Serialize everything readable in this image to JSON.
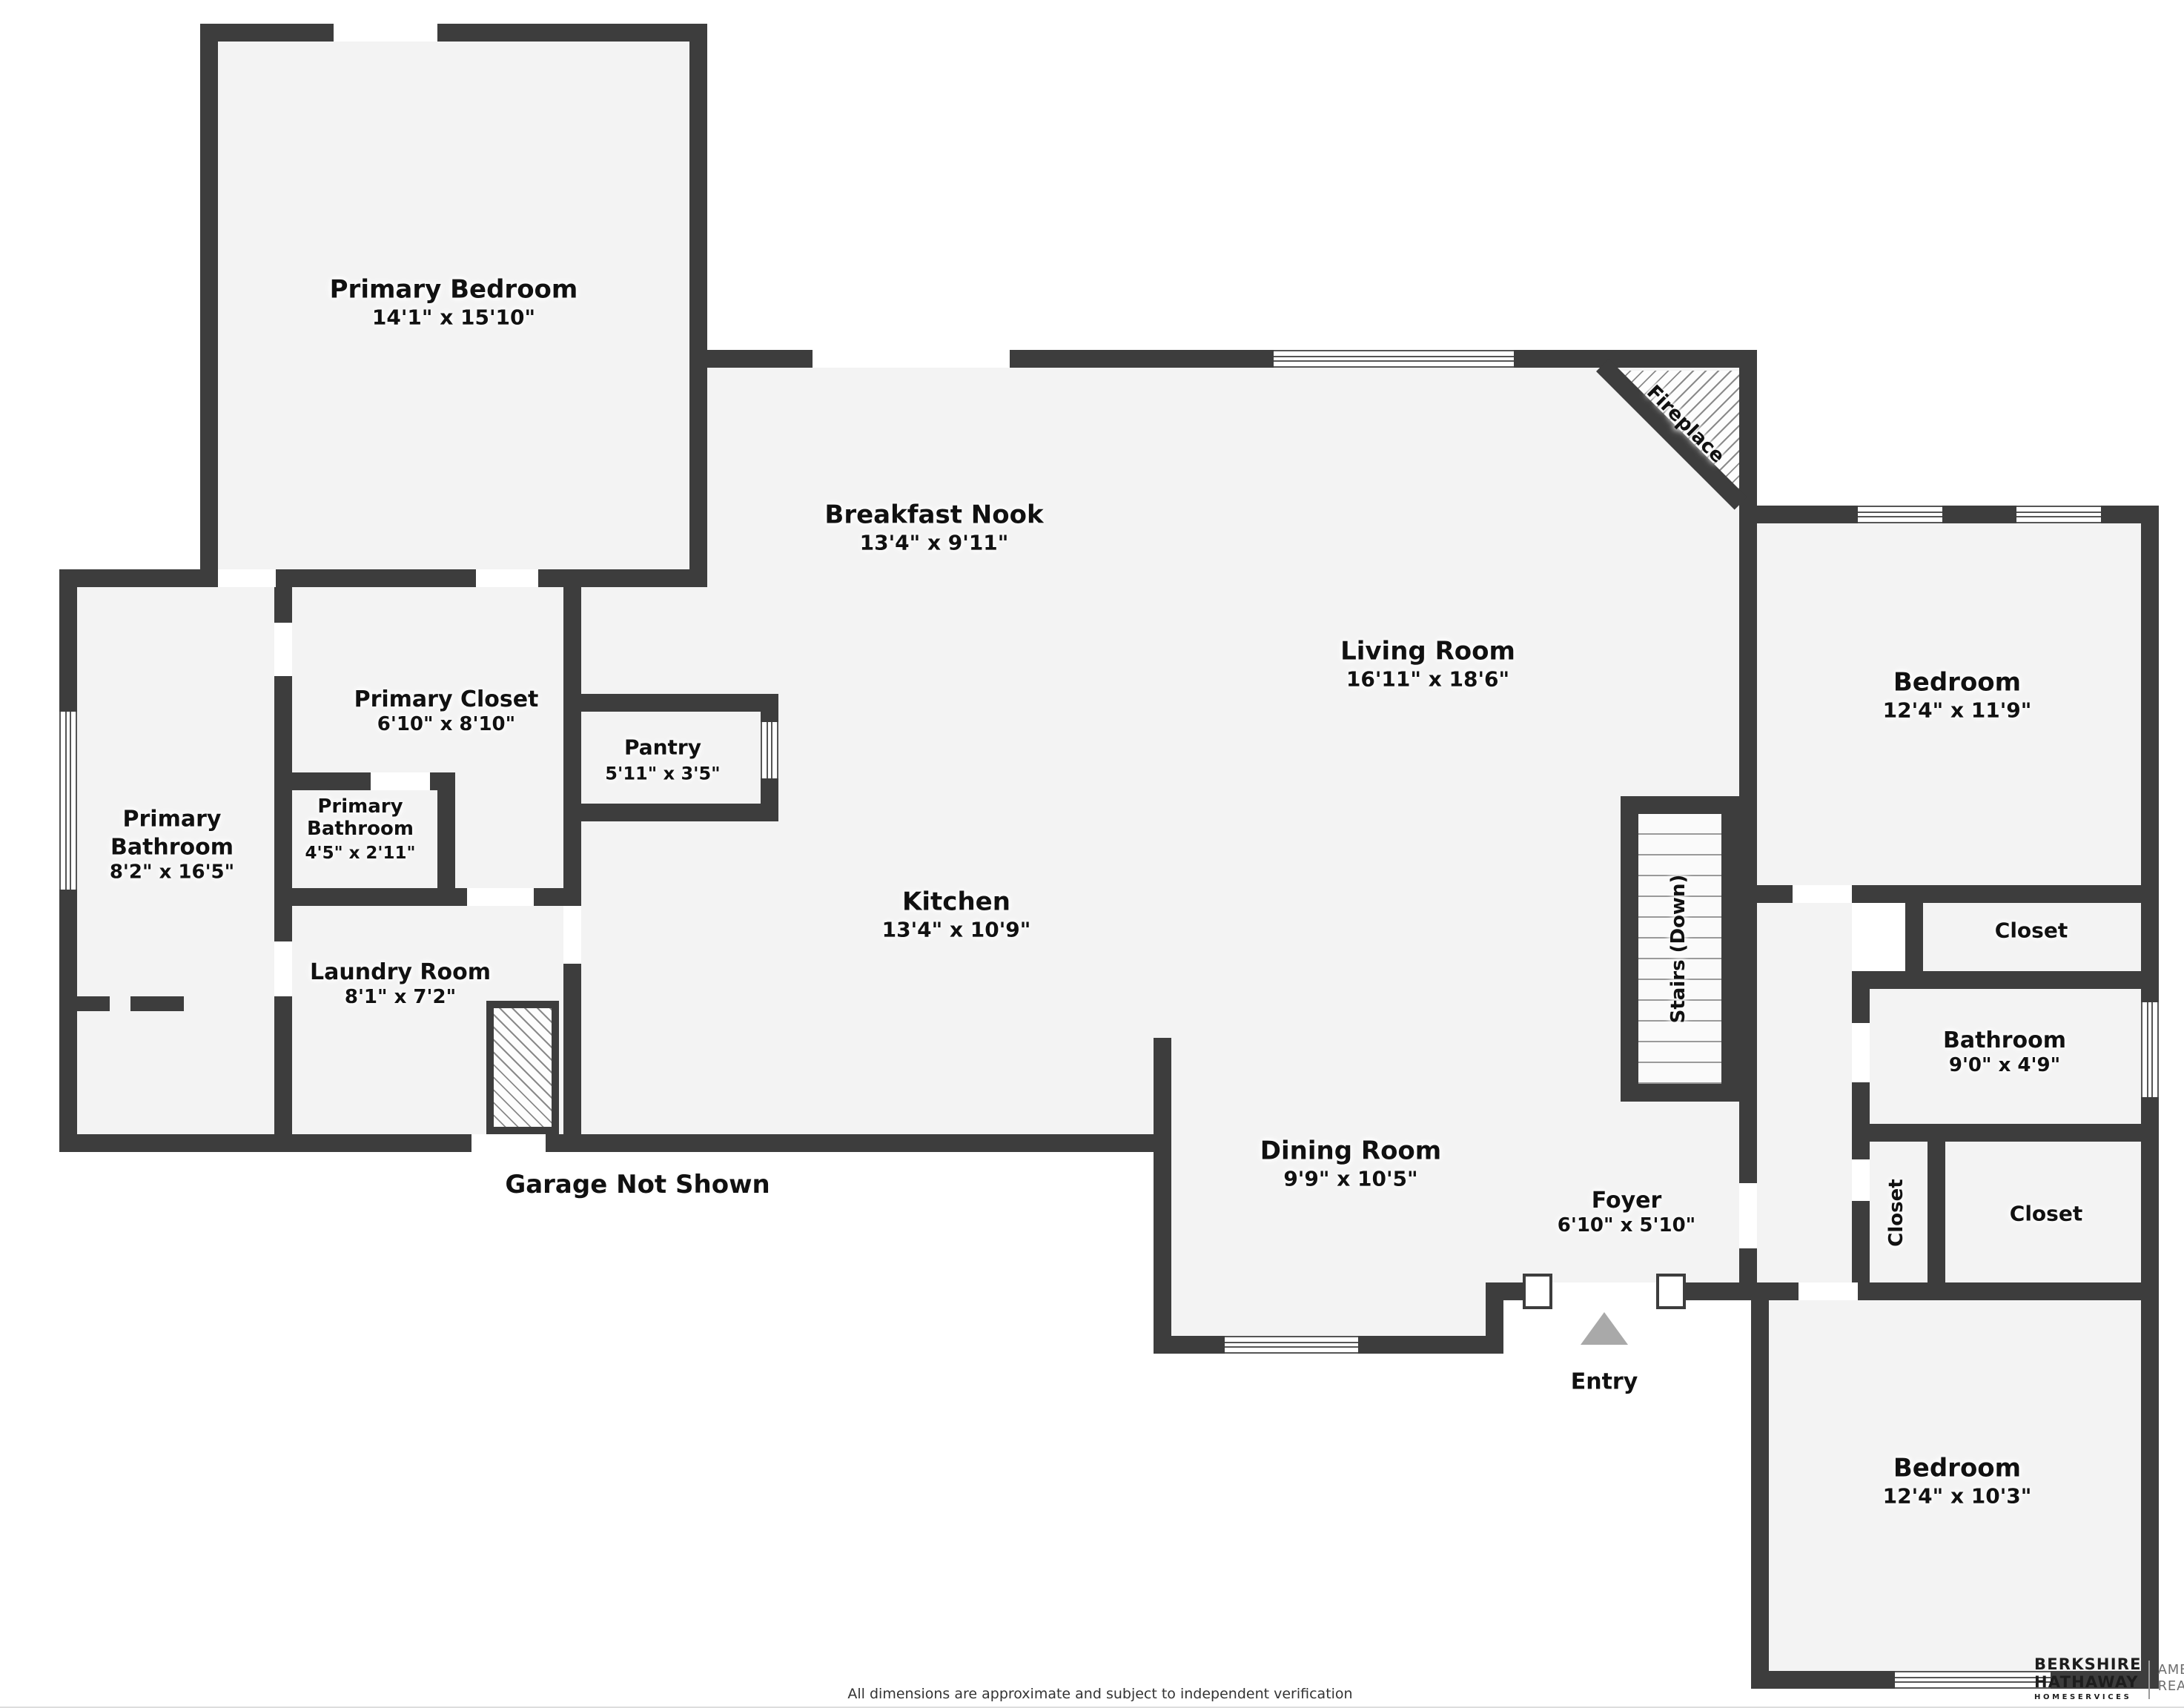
{
  "disclaimer": "All dimensions are approximate and subject to independent verification",
  "brand": {
    "line1": "BERKSHIRE",
    "line2": "HATHAWAY",
    "line3": "HOMESERVICES",
    "right1": "AMBASSADOR",
    "right2": "REAL ESTATE"
  },
  "annotations": {
    "garage_note": "Garage Not Shown",
    "entry": "Entry",
    "stairs": "Stairs (Down)",
    "fireplace": "Fireplace"
  },
  "rooms": {
    "primary_bedroom": {
      "name": "Primary Bedroom",
      "dims": "14'1\" x 15'10\""
    },
    "breakfast_nook": {
      "name": "Breakfast Nook",
      "dims": "13'4\" x 9'11\""
    },
    "living_room": {
      "name": "Living Room",
      "dims": "16'11\" x 18'6\""
    },
    "primary_closet": {
      "name": "Primary Closet",
      "dims": "6'10\" x 8'10\""
    },
    "pantry": {
      "name": "Pantry",
      "dims": "5'11\" x 3'5\""
    },
    "primary_bathroom": {
      "name1": "Primary",
      "name2": "Bathroom",
      "dims": "8'2\" x 16'5\""
    },
    "primary_bathroom_small": {
      "name1": "Primary",
      "name2": "Bathroom",
      "dims": "4'5\" x 2'11\""
    },
    "kitchen": {
      "name": "Kitchen",
      "dims": "13'4\" x 10'9\""
    },
    "laundry": {
      "name": "Laundry Room",
      "dims": "8'1\" x 7'2\""
    },
    "dining": {
      "name": "Dining Room",
      "dims": "9'9\" x 10'5\""
    },
    "foyer": {
      "name": "Foyer",
      "dims": "6'10\" x 5'10\""
    },
    "bedroom_upper": {
      "name": "Bedroom",
      "dims": "12'4\" x 11'9\""
    },
    "bathroom": {
      "name": "Bathroom",
      "dims": "9'0\" x 4'9\""
    },
    "closet_upper": {
      "name": "Closet"
    },
    "closet_hall": {
      "name": "Closet"
    },
    "closet_lower": {
      "name": "Closet"
    },
    "bedroom_lower": {
      "name": "Bedroom",
      "dims": "12'4\" x 10'3\""
    }
  },
  "colors": {
    "wall": "#3d3d3d",
    "floor": "#f3f3f3",
    "entry_arrow": "#a9a9a9"
  }
}
